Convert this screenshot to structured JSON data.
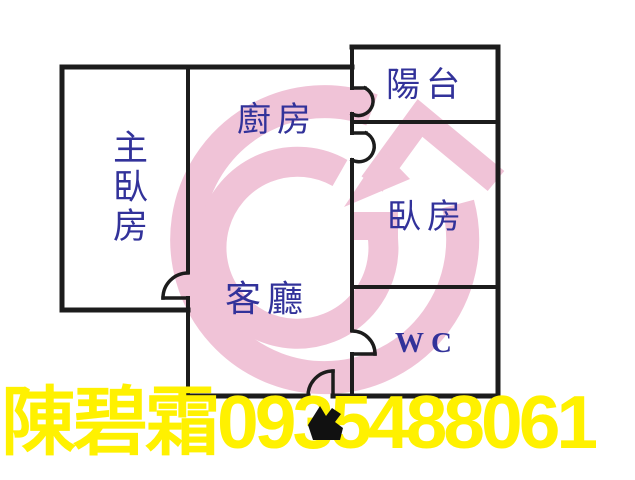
{
  "floor_plan": {
    "wall_color": "#1c1c1c",
    "label_color": "#32329a",
    "rooms": [
      {
        "name": "master-bedroom",
        "label": "主臥房",
        "orientation": "vertical"
      },
      {
        "name": "kitchen",
        "label": "廚房",
        "orientation": "horizontal"
      },
      {
        "name": "balcony",
        "label": "陽台",
        "orientation": "horizontal"
      },
      {
        "name": "bedroom",
        "label": "臥房",
        "orientation": "horizontal"
      },
      {
        "name": "living-room",
        "label": "客廳",
        "orientation": "horizontal"
      },
      {
        "name": "wc",
        "label": "WC",
        "orientation": "horizontal"
      }
    ],
    "doors": [
      "master-bedroom-door",
      "balcony-door",
      "bedroom-door",
      "wc-door",
      "entrance-door"
    ],
    "entrance_marker": "entrance-arrow"
  },
  "watermark": {
    "description": "pink real-estate agency logo: letter G with house roof arrow",
    "color": "#f0c3d7"
  },
  "contact": {
    "name": "陳碧霜",
    "phone": "0935488061",
    "text_color": "#fff100"
  }
}
